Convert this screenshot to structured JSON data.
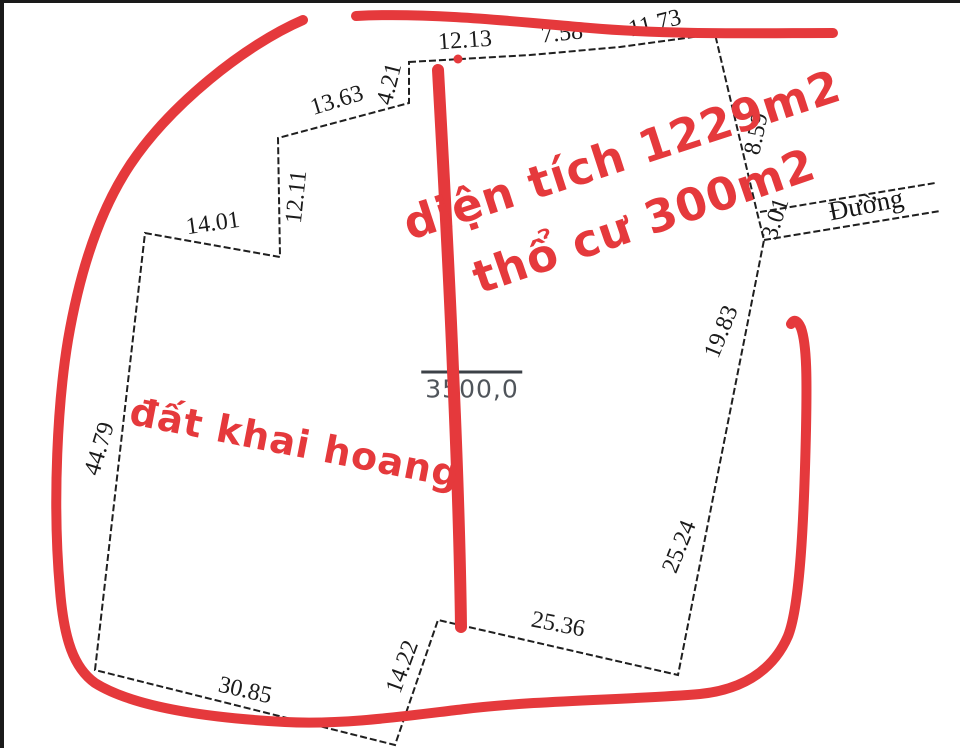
{
  "parcel": {
    "edges": {
      "top_1": "12.13",
      "top_2": "7.58",
      "top_3": "11.73",
      "nw_slant": "13.63",
      "nw_step": "4.21",
      "nw_vertical": "12.11",
      "west_shoulder": "14.01",
      "west": "44.79",
      "south": "30.85",
      "south_step": "14.22",
      "south_east": "25.36",
      "east_lower": "25.24",
      "east_upper": "19.83",
      "north_east": "8.59",
      "road_frontage": "3.01"
    },
    "area_label": "3500,0"
  },
  "road": {
    "label": "Đường"
  },
  "annotations": {
    "total_area": "diện tích 1229m2",
    "residential_area": "thổ cư 300m2",
    "reclaimed_land": "đất khai hoang"
  },
  "colors": {
    "marker_red": "#e5393c",
    "outline_black": "#1f1f1f",
    "area_gray": "#50555b",
    "background": "#ffffff"
  }
}
